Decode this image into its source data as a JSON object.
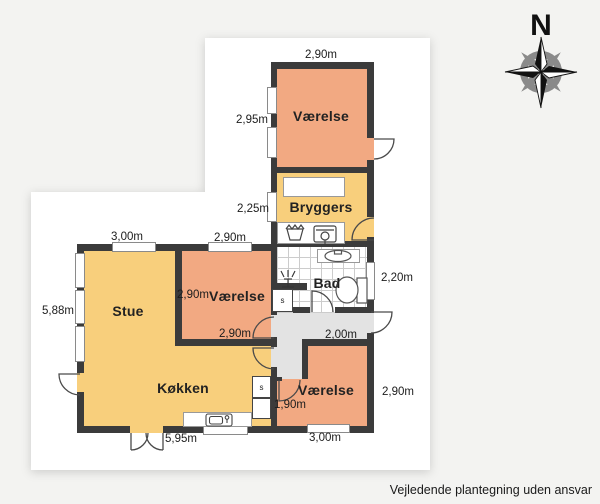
{
  "colors": {
    "room_salmon": "#f2a982",
    "room_yellow": "#f8cf7c",
    "hall_gray": "#e3e3e3",
    "wall": "#3b3b3b"
  },
  "compass": {
    "north": "N"
  },
  "footer": {
    "text": "Vejledende plantegning uden ansvar"
  },
  "rooms": {
    "vaerelse_nord": {
      "label": "Værelse",
      "dim_top": "2,90m",
      "dim_left": "2,95m"
    },
    "bryggers": {
      "label": "Bryggers",
      "dim_left": "2,25m"
    },
    "bad": {
      "label": "Bad",
      "dim_right": "2,20m"
    },
    "entre": {
      "dim_width": "2,00m"
    },
    "vaerelse_midt": {
      "label": "Værelse",
      "dim_inner_left": "2,90m",
      "dim_top": "2,90m",
      "dim_bottom": "2,90m"
    },
    "stue": {
      "label": "Stue",
      "dim_top": "3,00m",
      "dim_left": "5,88m"
    },
    "koekken": {
      "label": "Køkken",
      "dim_bottom": "5,95m"
    },
    "vaerelse_syd": {
      "label": "Værelse",
      "dim_right": "2,90m",
      "dim_bottom": "3,00m",
      "dim_inner": "1,90m"
    },
    "closet_bad": {
      "label": "s"
    },
    "closet_koekken": {
      "label": "s"
    }
  }
}
